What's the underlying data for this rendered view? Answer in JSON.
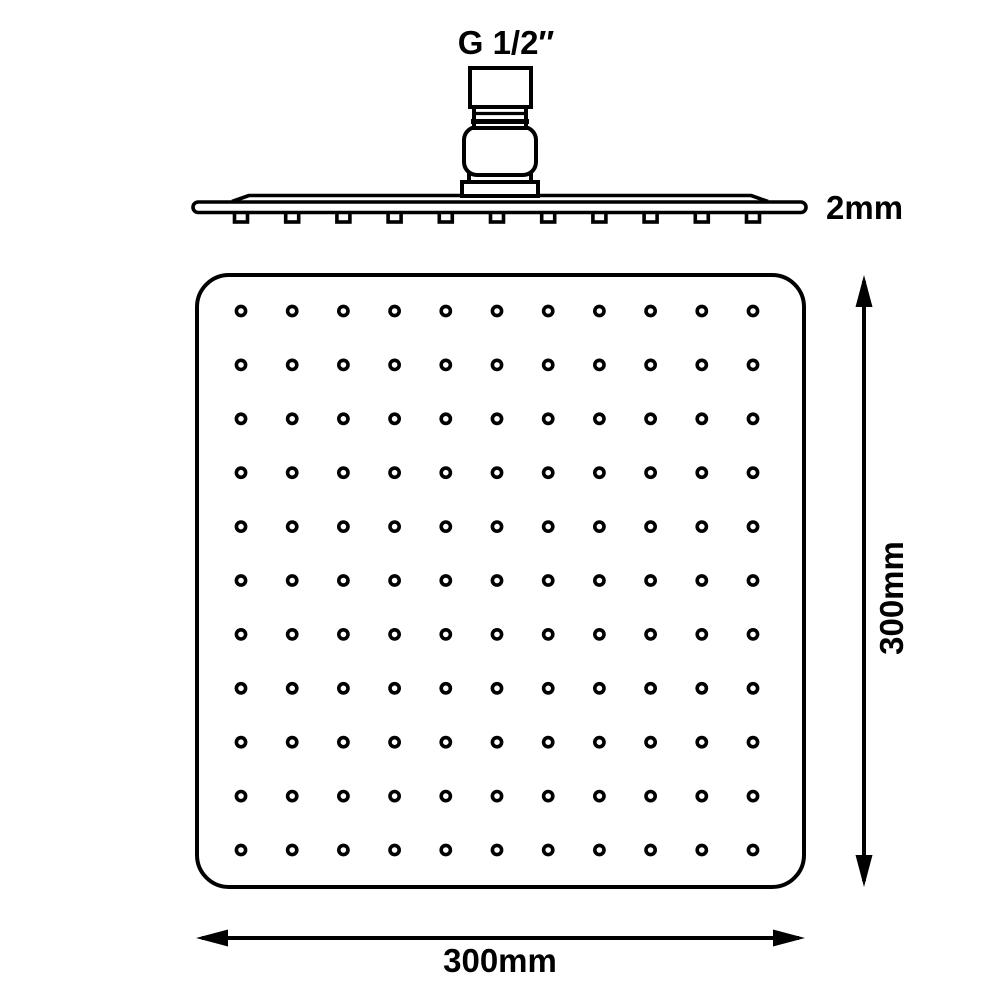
{
  "diagram": {
    "type": "technical-drawing",
    "subject": "Square rain shower head with thread connector, side profile and face views with dimensions",
    "labels": {
      "thread_size": "G 1/2″",
      "thickness": "2mm",
      "height_dimension": "300mm",
      "width_dimension": "300mm"
    },
    "colors": {
      "line": "#000000",
      "background": "#ffffff"
    },
    "front_view": {
      "nozzle_rows": 11,
      "nozzle_columns": 11,
      "nozzle_count": 121
    },
    "side_view": {
      "nozzle_count": 11
    }
  }
}
